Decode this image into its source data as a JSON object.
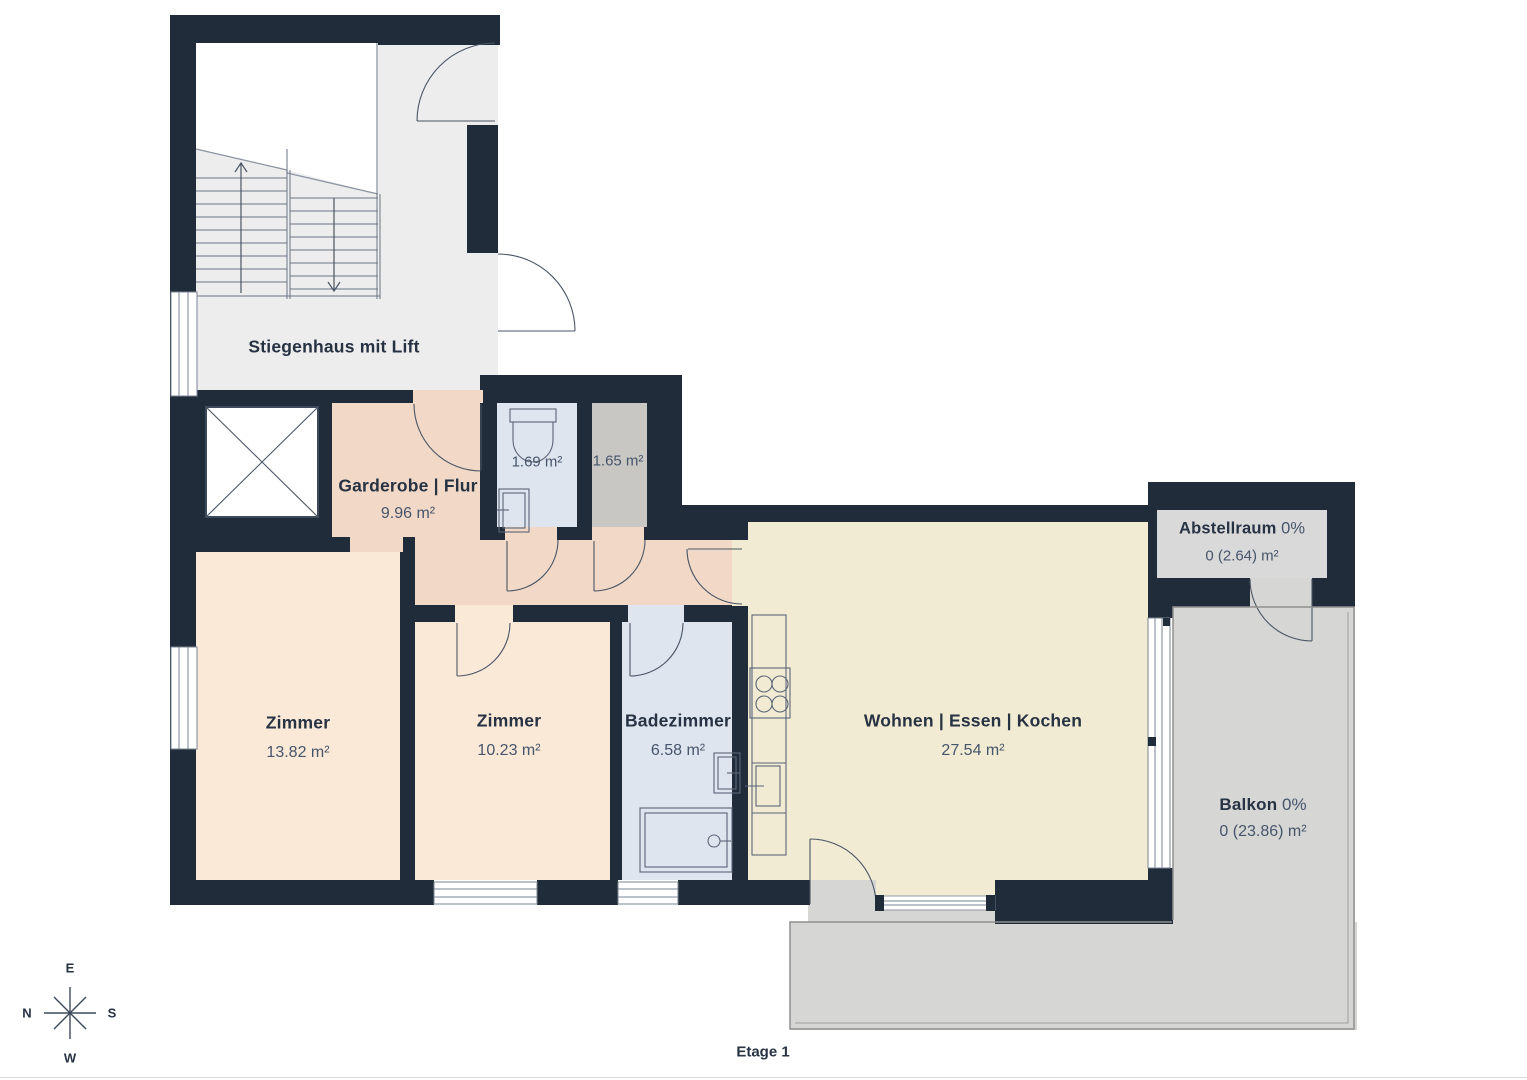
{
  "title": "Etage 1",
  "colors": {
    "wall": "#212C3A",
    "stairwell_floor": "#EDEDED",
    "hall_floor": "#F2D8C7",
    "room_floor": "#FBE9D8",
    "bath_floor": "#DFE5EF",
    "small_storage_floor": "#C9C7C3",
    "living_floor": "#F2EBD3",
    "balcony_floor": "#D6D6D4",
    "label_box": "#D9D9D9"
  },
  "rooms": {
    "stiegenhaus": {
      "label": "Stiegenhaus mit Lift"
    },
    "garderobe": {
      "label": "Garderobe | Flur",
      "area": "9.96 m²"
    },
    "wc": {
      "area": "1.69 m²"
    },
    "kleiner_raum": {
      "area": "1.65 m²"
    },
    "zimmer1": {
      "label": "Zimmer",
      "area": "13.82 m²"
    },
    "zimmer2": {
      "label": "Zimmer",
      "area": "10.23 m²"
    },
    "badezimmer": {
      "label": "Badezimmer",
      "area": "6.58 m²"
    },
    "wohnen": {
      "label": "Wohnen | Essen | Kochen",
      "area": "27.54 m²"
    },
    "abstellraum": {
      "label": "Abstellraum",
      "percent": "0%",
      "area": "0 (2.64) m²"
    },
    "balkon": {
      "label": "Balkon",
      "percent": "0%",
      "area": "0 (23.86) m²"
    }
  },
  "compass": {
    "top": "E",
    "bottom": "W",
    "left": "N",
    "right": "S"
  },
  "footer": {
    "floor_label": "Etage 1"
  }
}
